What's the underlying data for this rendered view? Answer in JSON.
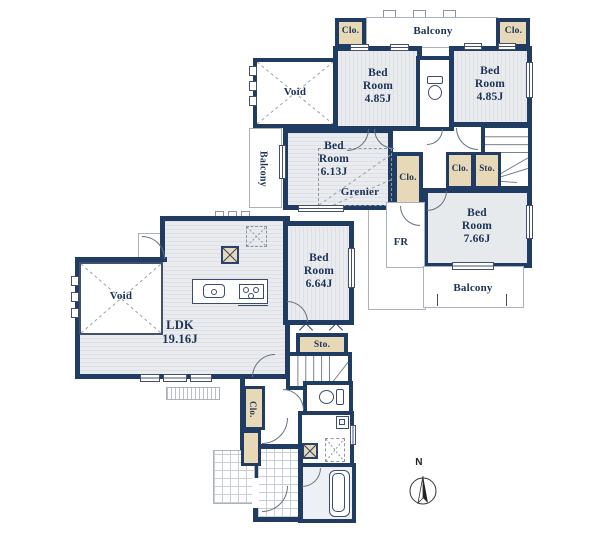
{
  "title": "floor-plan",
  "colors": {
    "wall": "#203c62",
    "closet_fill": "#e7d9b8",
    "floor_fill": "#e9ebee",
    "text": "#1c3355",
    "bath_fill": "#edf1f5"
  },
  "floor2": {
    "clo_top_left": "Clo.",
    "balcony_top": "Balcony",
    "clo_top_right": "Clo.",
    "bedroom_nw": "Bed\nRoom\n4.85J",
    "bedroom_ne": "Bed\nRoom\n4.85J",
    "void": "Void",
    "balcony_left": "Balcony",
    "bedroom_mid": "Bed\nRoom\n6.13J",
    "grenier": "Grenier",
    "clo_mid": "Clo.",
    "clo_small": "Clo.",
    "sto_small": "Sto.",
    "bedroom_se": "Bed\nRoom\n7.66J",
    "fr": "FR",
    "balcony_bottom": "Balcony"
  },
  "floor1": {
    "void": "Void",
    "ldk": "LDK\n19.16J",
    "bedroom": "Bed\nRoom\n6.64J",
    "sto": "Sto.",
    "clo": "Clo."
  },
  "compass": {
    "north": "N"
  }
}
